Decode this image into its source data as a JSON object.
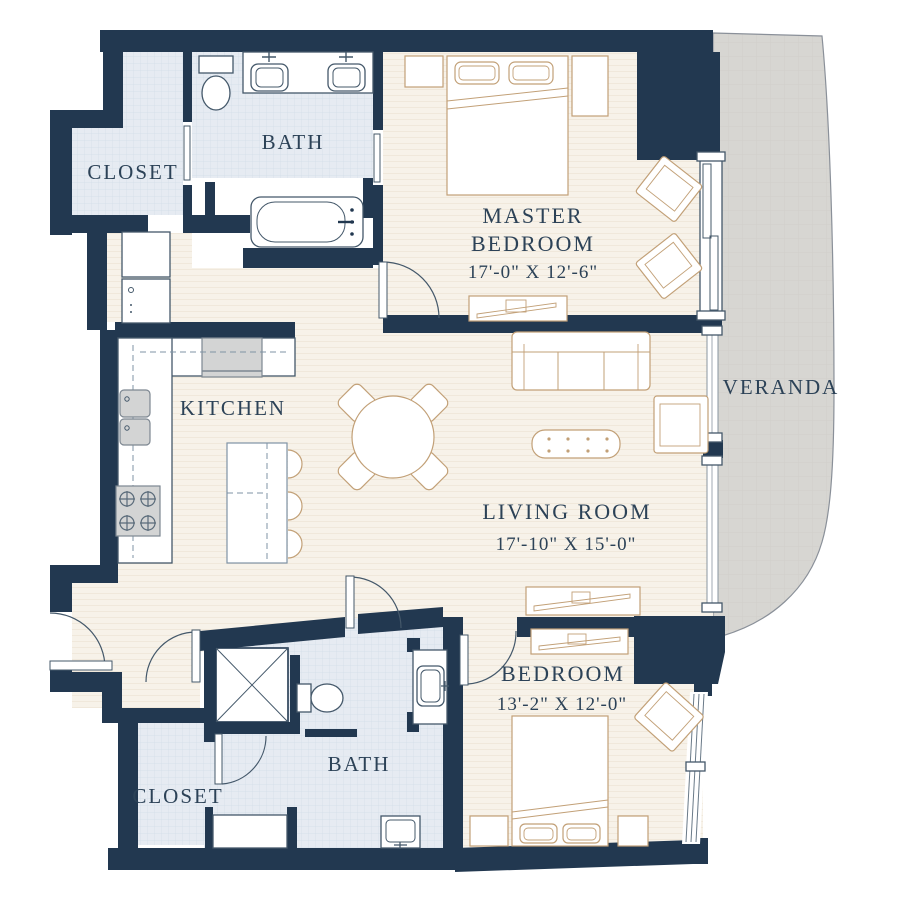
{
  "rooms": {
    "closet_top": {
      "label": "CLOSET"
    },
    "bath_top": {
      "label": "BATH"
    },
    "master_bedroom": {
      "line1": "MASTER",
      "line2": "BEDROOM",
      "dims": "17'-0\" X 12'-6\""
    },
    "veranda": {
      "label": "VERANDA"
    },
    "kitchen": {
      "label": "KITCHEN"
    },
    "living_room": {
      "label": "LIVING ROOM",
      "dims": "17'-10\" X 15'-0\""
    },
    "bedroom": {
      "label": "BEDROOM",
      "dims": "13'-2\" X 12'-0\""
    },
    "closet_bottom": {
      "label": "CLOSET"
    },
    "bath_bottom": {
      "label": "BATH"
    }
  },
  "colors": {
    "wall": "#223850",
    "floor": "#f7f2e9",
    "tile": "#e6ebf2",
    "tile_grid": "#d3dde8",
    "veranda": "#d7d6d2",
    "furniture_outline": "#c2a077",
    "fixture_outline": "#44586a",
    "label_text": "#2c4257"
  }
}
